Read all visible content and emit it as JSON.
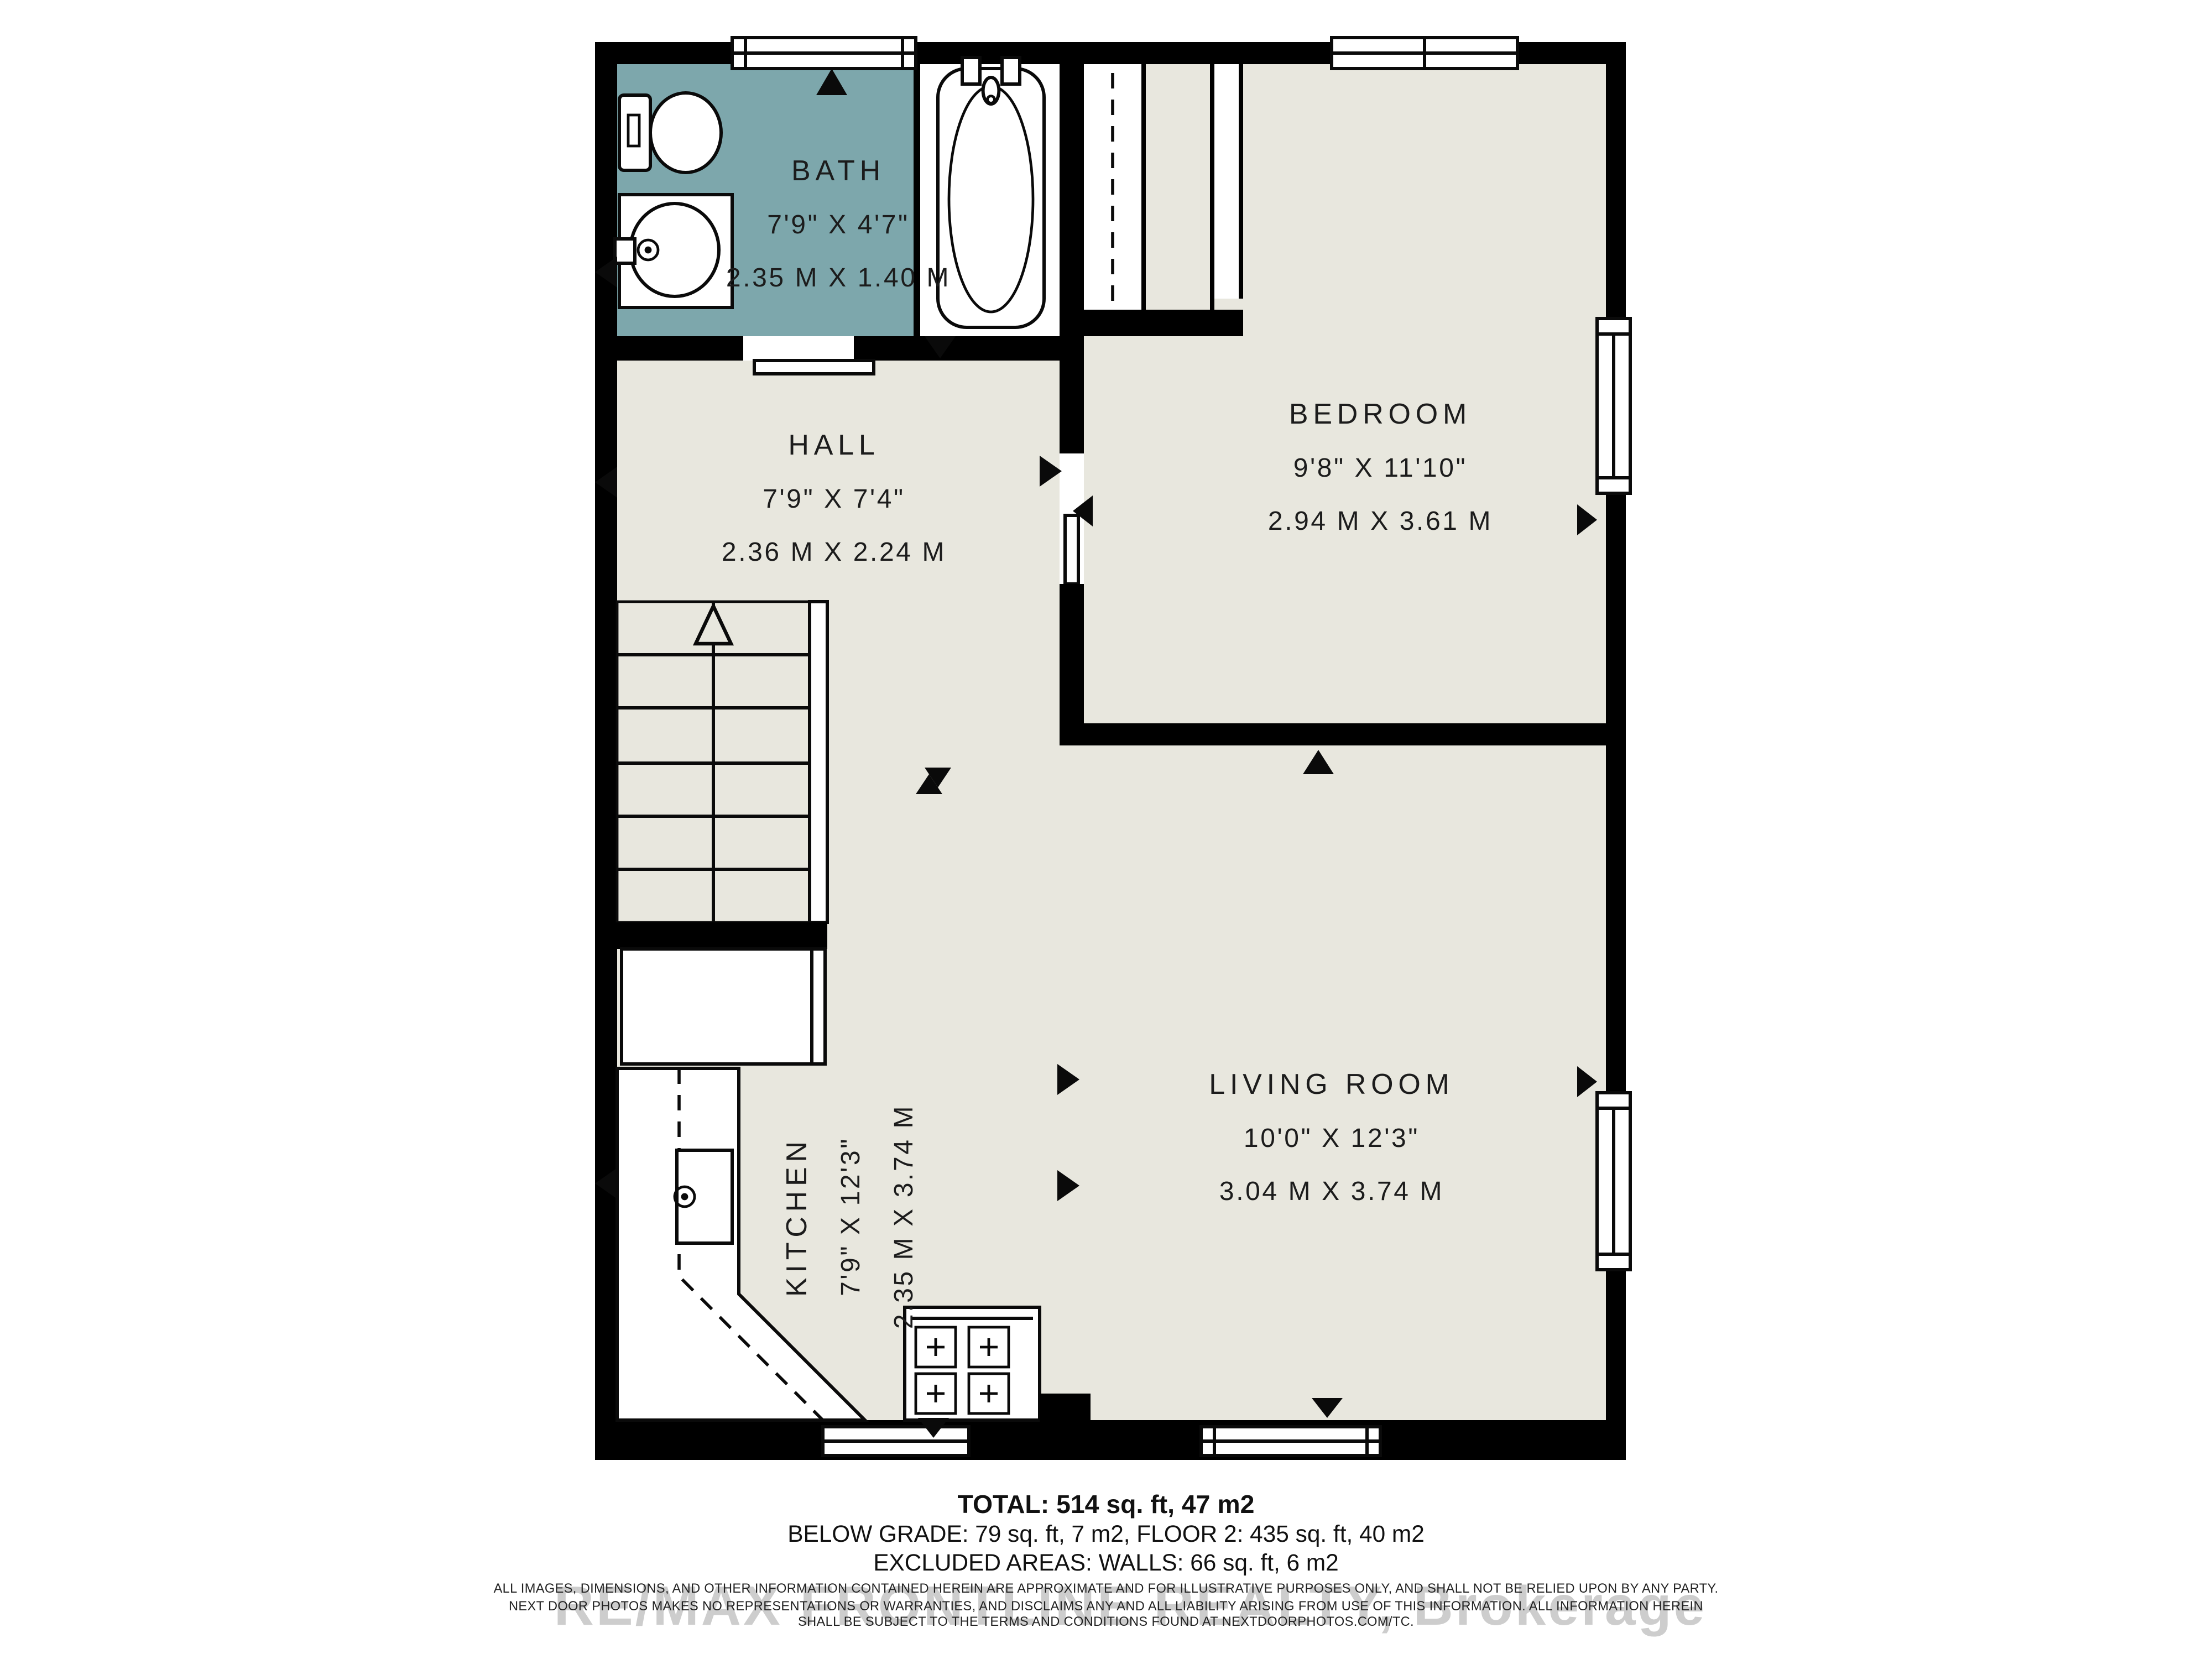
{
  "plan": {
    "colors": {
      "bath_floor": "#7da7ac",
      "floor": "#e8e7de",
      "wall": "#000000"
    },
    "rooms": {
      "bath": {
        "name": "BATH",
        "imperial": "7'9\" X 4'7\"",
        "metric": "2.35 M X 1.40 M"
      },
      "hall": {
        "name": "HALL",
        "imperial": "7'9\" X 7'4\"",
        "metric": "2.36 M X 2.24 M"
      },
      "bedroom": {
        "name": "BEDROOM",
        "imperial": "9'8\" X 11'10\"",
        "metric": "2.94 M X 3.61 M"
      },
      "living": {
        "name": "LIVING ROOM",
        "imperial": "10'0\" X 12'3\"",
        "metric": "3.04 M X 3.74 M"
      },
      "kitchen": {
        "name": "KITCHEN",
        "imperial": "7'9\" X 12'3\"",
        "metric": "2.35 M X 3.74 M"
      }
    }
  },
  "footer": {
    "total": "TOTAL: 514 sq. ft, 47 m2",
    "breakdown": "BELOW GRADE: 79 sq. ft, 7 m2, FLOOR 2: 435 sq. ft, 40 m2",
    "excluded": "EXCLUDED AREAS: WALLS: 66 sq. ft, 6 m2",
    "disclaimer_line1": "ALL IMAGES, DIMENSIONS, AND OTHER INFORMATION CONTAINED HEREIN ARE APPROXIMATE AND FOR ILLUSTRATIVE PURPOSES ONLY, AND SHALL NOT BE RELIED UPON BY ANY PARTY.",
    "disclaimer_line2": "NEXT DOOR PHOTOS MAKES NO REPRESENTATIONS OR WARRANTIES, AND DISCLAIMS ANY AND ALL LIABILITY ARISING FROM USE OF THIS INFORMATION. ALL INFORMATION HEREIN",
    "disclaimer_line3": "SHALL BE SUBJECT TO THE TERMS AND CONDITIONS FOUND AT NEXTDOORPHOTOS.COM/TC.",
    "watermark": "RE/MAX FRONTLINE REALTY, Brokerage"
  }
}
